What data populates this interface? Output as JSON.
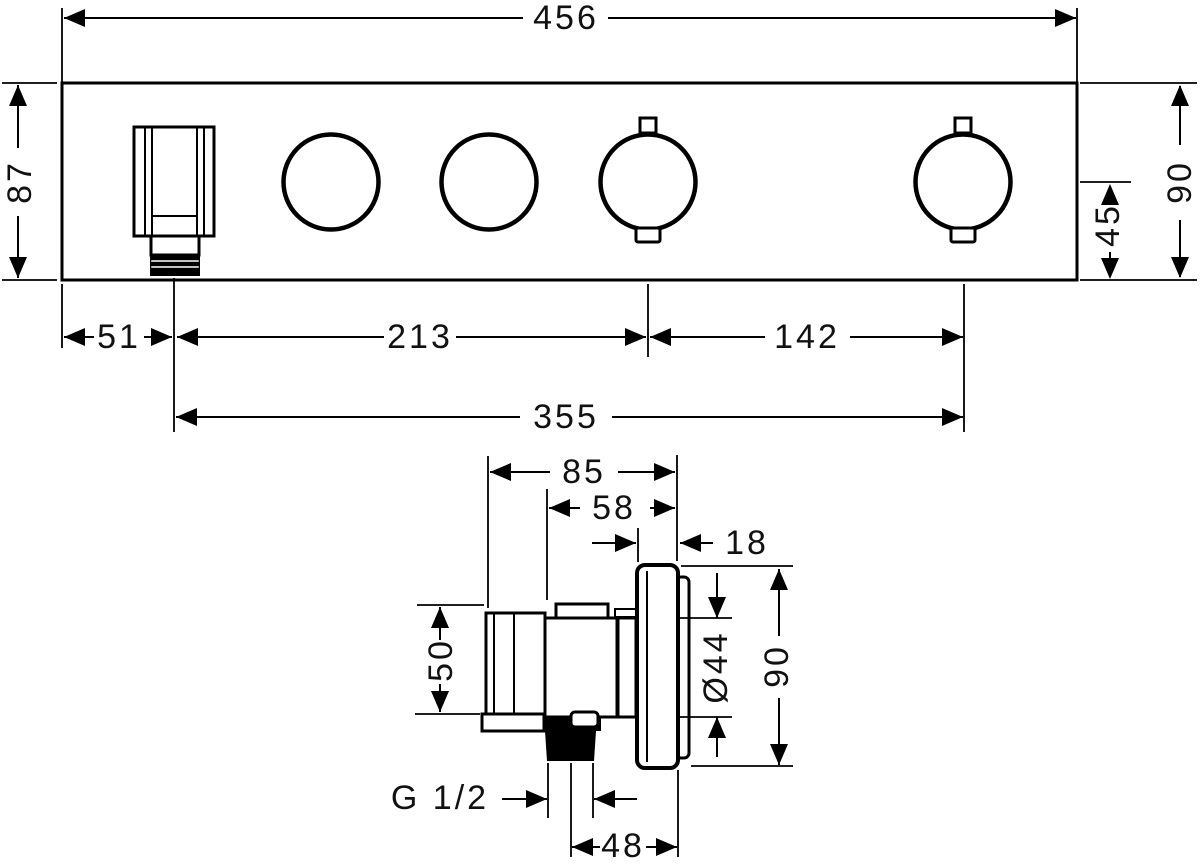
{
  "drawing": {
    "kind": "technical dimensional drawing",
    "line_color": "#000000",
    "background": "#ffffff",
    "front_view": {
      "description": "thermostat module front view with hand shower holder and four round controls",
      "dims": {
        "width": "456",
        "height": "87",
        "height_right": "90",
        "center_to_bottom": "45",
        "left_to_holder": "51",
        "holder_to_knob3": "213",
        "knob3_to_knob4": "142",
        "holder_to_knob4": "355"
      }
    },
    "side_view": {
      "description": "side section view with escutcheon, knob and hose connection",
      "dims": {
        "total_depth": "85",
        "body_depth": "58",
        "plate_depth": "18",
        "holder_height": "50",
        "knob_diameter": "Ø44",
        "plate_height": "90",
        "hose_thread": "G 1/2",
        "thread_to_wall": "48"
      }
    }
  }
}
